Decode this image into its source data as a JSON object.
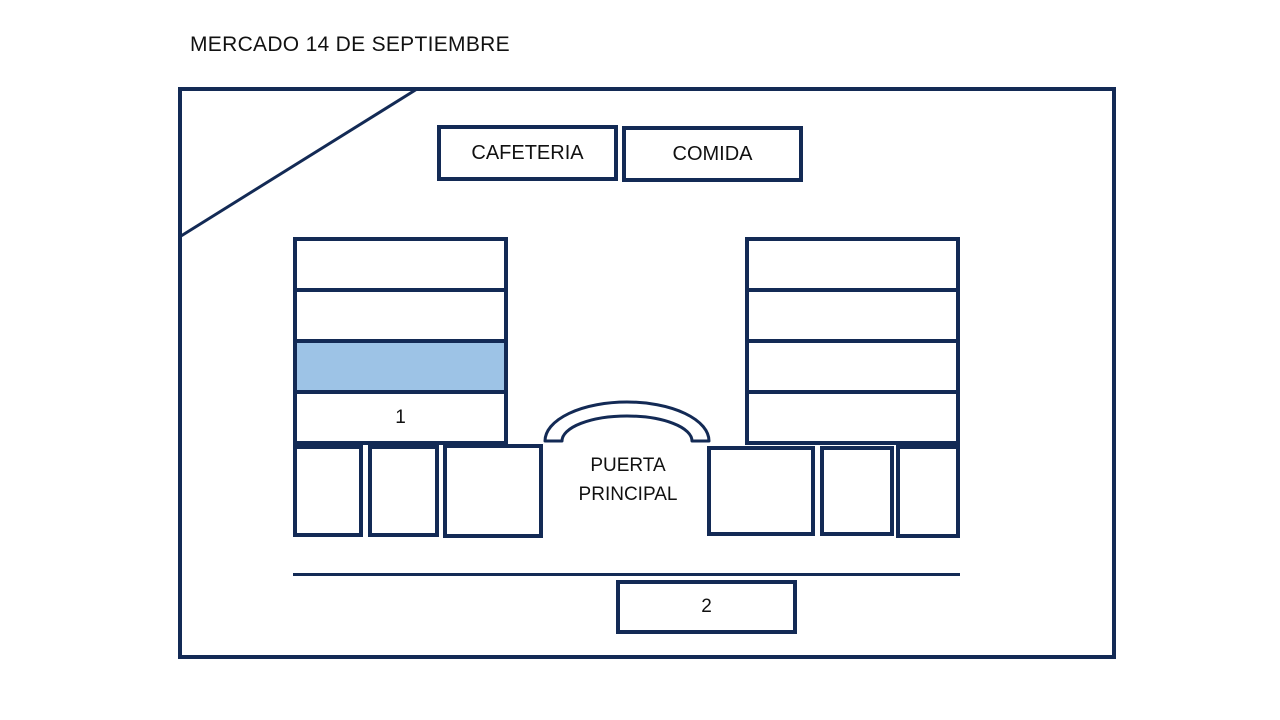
{
  "title": "MERCADO 14 DE SEPTIEMBRE",
  "labels": {
    "cafeteria": "CAFETERIA",
    "comida": "COMIDA",
    "entrance_line1": "PUERTA",
    "entrance_line2": "PRINCIPAL",
    "stall1": "1",
    "stall2": "2"
  },
  "colors": {
    "outline": "#132A55",
    "highlight_fill": "#9DC3E6",
    "text": "#111111",
    "canvas": "#FFFFFF"
  }
}
